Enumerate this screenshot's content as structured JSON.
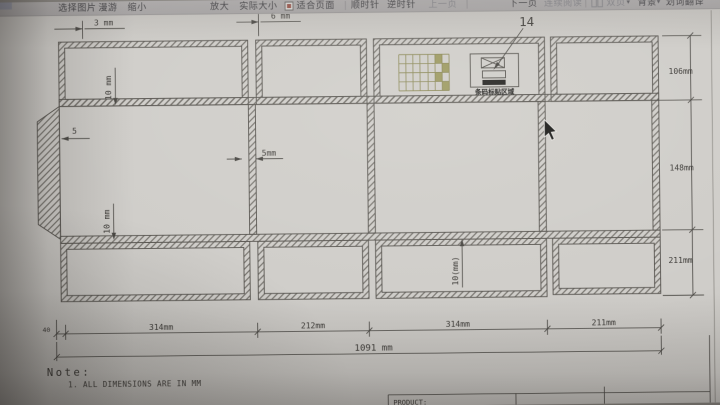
{
  "toolbar": {
    "caret_char": "▾",
    "items": [
      {
        "label": "选择图片",
        "muted": false
      },
      {
        "label": "漫游",
        "muted": false
      },
      {
        "label": "缩小",
        "muted": false
      },
      {
        "label": "放大",
        "muted": false
      },
      {
        "label": "实际大小",
        "muted": false
      },
      {
        "label": "适合页面",
        "muted": false
      },
      {
        "label": "顺时针",
        "muted": false
      },
      {
        "label": "逆时针",
        "muted": false
      },
      {
        "label": "上一页",
        "muted": true
      },
      {
        "label": "下一页",
        "muted": false
      },
      {
        "label": "连续阅读",
        "muted": true
      },
      {
        "label": "双页",
        "muted": true
      },
      {
        "label": "背景",
        "muted": false
      },
      {
        "label": "划词翻译",
        "muted": false
      }
    ]
  },
  "drawing": {
    "callout_14": "14",
    "dim_3mm": "3 mm",
    "dim_6mm": "6 mm",
    "dim_10mm_top": "10 mm",
    "dim_5": "5",
    "dim_5mm": "5mm",
    "dim_10mm_bottom": "10 mm",
    "dim_10mm_mid": "10(mm)",
    "dims_right": [
      "106mm",
      "148mm",
      "211mm"
    ],
    "dims_bottom": {
      "offset": "40",
      "segments": [
        "314mm",
        "212mm",
        "314mm",
        "211mm"
      ],
      "total": "1091 mm"
    },
    "stamp_label": "条码标贴区域",
    "note": {
      "title": "Note:",
      "line1": "1. ALL DIMENSIONS ARE IN MM"
    },
    "titleblock": {
      "product_label": "PRODUCT:"
    },
    "colors": {
      "paper": "#d3d0cb",
      "line": "#55524c",
      "grid_olive": "#8d8a4e",
      "grid_fill": "#9e9b55",
      "stamp_black": "#201f1d"
    }
  }
}
